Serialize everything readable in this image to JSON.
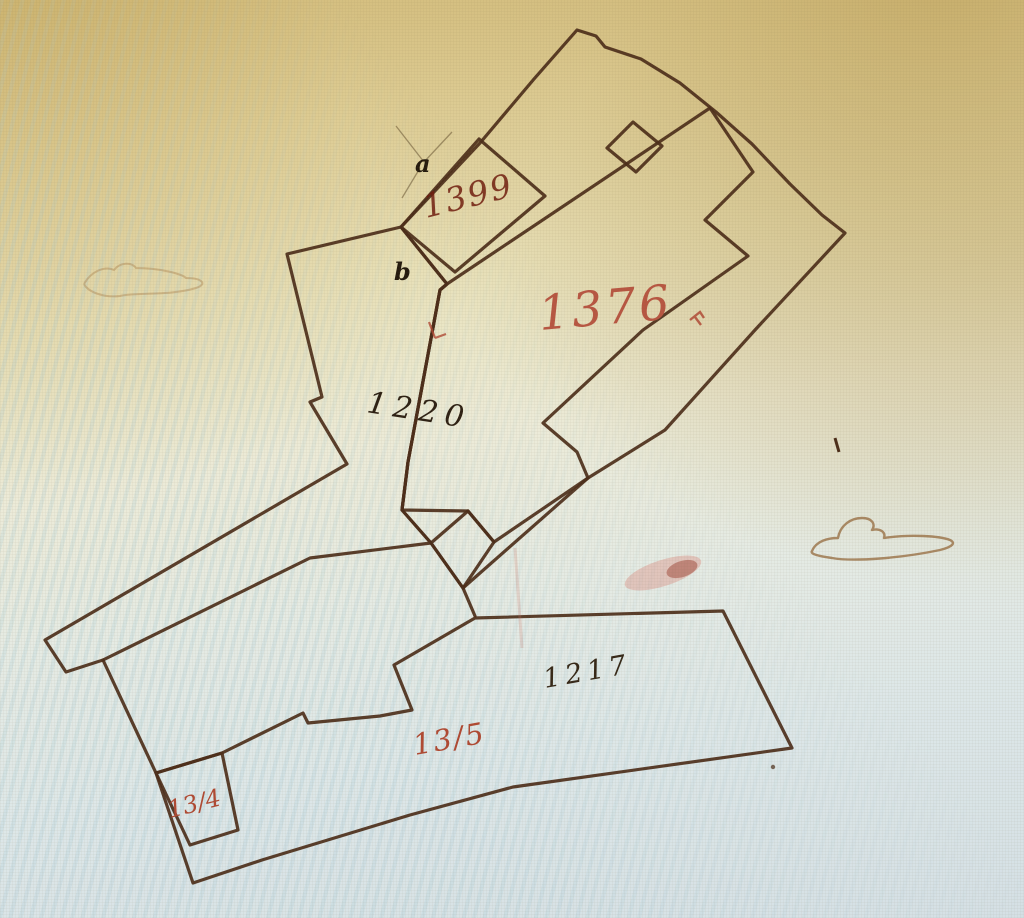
{
  "map": {
    "description": "Photograph of a hand-drawn historical cadastral plan with coloured building parcels",
    "ink_color": "#4c2e1a",
    "red_ink_color": "#b24a36",
    "labels": {
      "building_dark": "1399",
      "building_pink": "1376",
      "parcel_left": "1220",
      "parcel_bottom": "1217",
      "parcel_bottom_red": "13/5",
      "parcel_small_red": "13/4",
      "mark_a": "a",
      "mark_b": "b"
    },
    "fills": {
      "dark_building": "#7c3a20",
      "pink_building_deep": "#e09c80",
      "pink_building_light": "#f5d8d2",
      "yard": "#eae8c2",
      "left_parcel": "#f0efdc",
      "bottom_parcel": "#eef3f1",
      "annex": "#f0ead2"
    }
  }
}
